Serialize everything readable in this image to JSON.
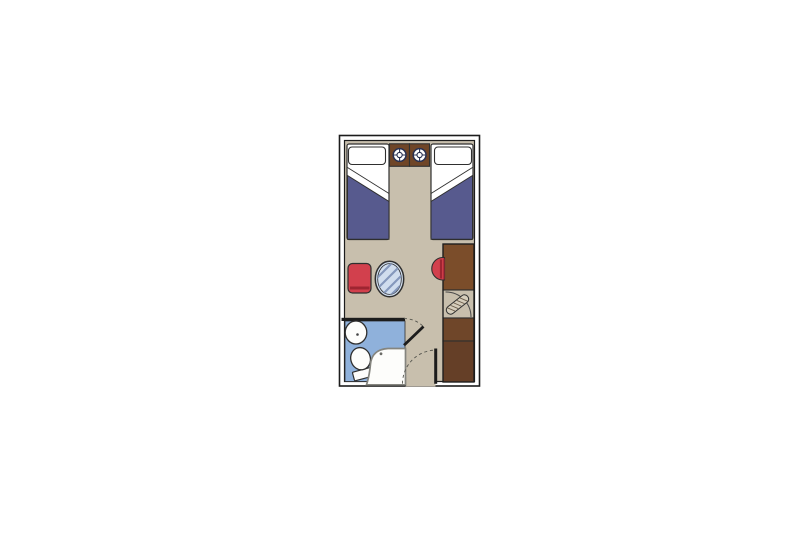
{
  "window": {
    "background": "#ffffff"
  },
  "floorplan": {
    "label": "ship-cabin-floor-plan",
    "colors": {
      "wall": "#1c1c1c",
      "wall_cavity": "#ffffff",
      "floor": "#c8bfad",
      "linen": "#ffffff",
      "blanket": "#575a8e",
      "wood_nightstand": "#6f4527",
      "dial": "#283050",
      "seat_red": "#d2404d",
      "seat_red_dark": "#9e2531",
      "table_glass": "#d0ddee",
      "table_hatch": "#8598bc",
      "wood_desk": "#7b4d2a",
      "wood_wardrobe_mid": "#6f4629",
      "wood_wardrobe_dark": "#653f27",
      "wardrobe_door_panel": "#d5cdbb",
      "wardrobe_door_hatch": "#6a5b49",
      "bathroom_floor": "#8fb1db",
      "fixture": "#fdfdfb",
      "shower_outline": "#85857f",
      "swing_arc": "#56564f"
    },
    "rooms": [
      {
        "name": "sleeping-area"
      },
      {
        "name": "sitting-area"
      },
      {
        "name": "bathroom"
      },
      {
        "name": "entrance-hall"
      }
    ],
    "furniture": [
      {
        "name": "twin-bed-left"
      },
      {
        "name": "twin-bed-right"
      },
      {
        "name": "nightstand-left"
      },
      {
        "name": "nightstand-right"
      },
      {
        "name": "reading-light-left"
      },
      {
        "name": "reading-light-right"
      },
      {
        "name": "armchair"
      },
      {
        "name": "oval-glass-table"
      },
      {
        "name": "desk"
      },
      {
        "name": "desk-stool"
      },
      {
        "name": "wardrobe"
      },
      {
        "name": "washbasin"
      },
      {
        "name": "toilet"
      },
      {
        "name": "shower"
      },
      {
        "name": "bathroom-door"
      },
      {
        "name": "entrance-door"
      }
    ]
  }
}
